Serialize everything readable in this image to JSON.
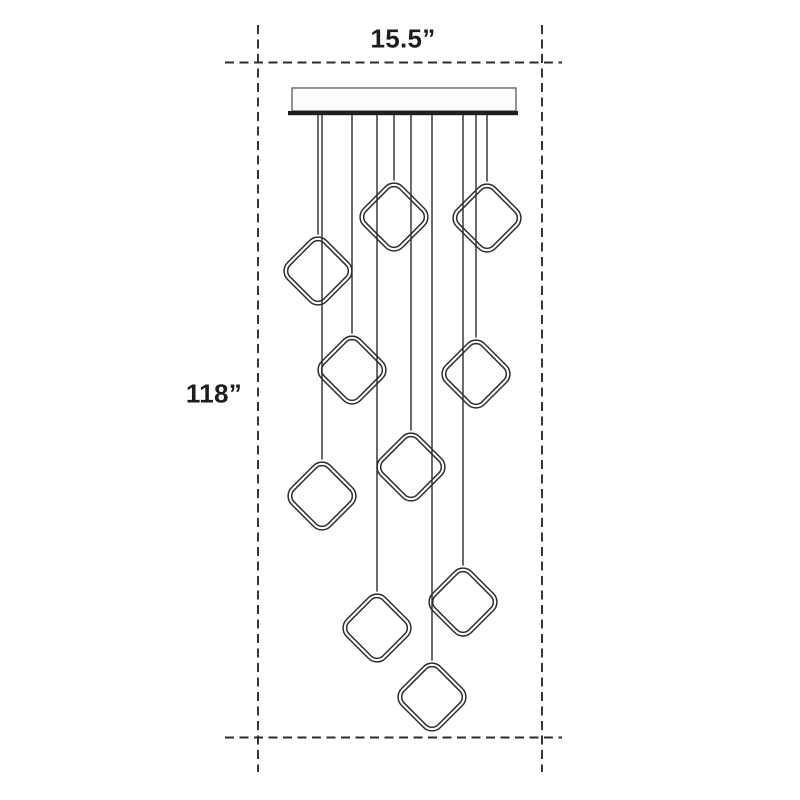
{
  "meta": {
    "description": "Dimension diagram of a 10-light multi-pendant chandelier with square ring pendants",
    "canvas": {
      "width": 800,
      "height": 800,
      "background": "#ffffff"
    }
  },
  "labels": {
    "width": "15.5”",
    "height": "118”",
    "font_size_px": 26,
    "color": "#1d1d1d",
    "width_pos": {
      "cx": 403,
      "cy": 39
    },
    "height_pos": {
      "cx": 214,
      "cy": 394
    }
  },
  "guides": {
    "color": "#2d2d2d",
    "stroke_width": 1.9,
    "dash": "9 5.5",
    "vertical": [
      {
        "x": 258,
        "y1": 25,
        "y2": 772
      },
      {
        "x": 542,
        "y1": 25,
        "y2": 772
      }
    ],
    "horizontal": [
      {
        "y": 62.5,
        "x1": 225,
        "x2": 562
      },
      {
        "y": 737.5,
        "x1": 225,
        "x2": 562
      }
    ]
  },
  "canopy": {
    "plate": {
      "x": 292,
      "y": 88,
      "width": 224,
      "height": 23,
      "stroke": "#6e6e6e",
      "stroke_width": 1.5,
      "fill": "#fdfdfd"
    },
    "bar": {
      "x": 288,
      "y": 111,
      "width": 230,
      "height": 4.2,
      "fill": "#1e1e1e"
    }
  },
  "cords": {
    "color": "#2d2d2d",
    "stroke_width": 1.4,
    "top_y": 115
  },
  "pendants": {
    "style": {
      "side": 55,
      "corner_radius": 12,
      "inner_inset": 3.6,
      "stroke": "#2d2d2d",
      "stroke_width": 1.5,
      "fill": "none"
    },
    "items": [
      {
        "cx": 394,
        "cy": 217
      },
      {
        "cx": 487,
        "cy": 218
      },
      {
        "cx": 318,
        "cy": 271
      },
      {
        "cx": 352,
        "cy": 370
      },
      {
        "cx": 476,
        "cy": 374
      },
      {
        "cx": 411,
        "cy": 467
      },
      {
        "cx": 322,
        "cy": 496
      },
      {
        "cx": 463,
        "cy": 602
      },
      {
        "cx": 377,
        "cy": 628
      },
      {
        "cx": 432,
        "cy": 697
      }
    ]
  }
}
